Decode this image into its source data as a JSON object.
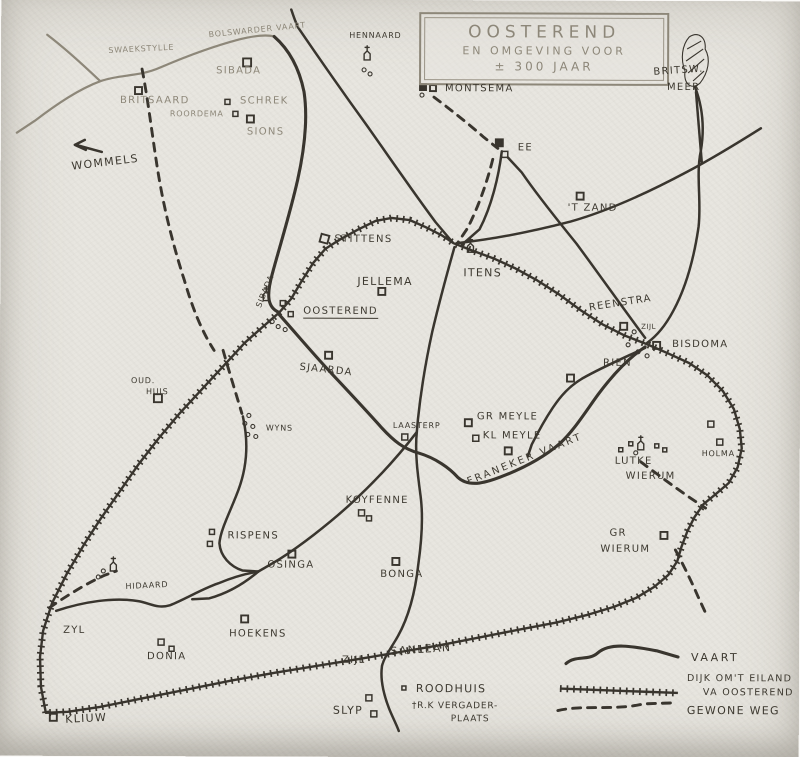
{
  "title": {
    "line1": "OOSTEREND",
    "line2": "EN OMGEVING VOOR",
    "line3": "± 300 JAAR"
  },
  "labels": {
    "swaekstylle": "SWAEKSTYLLE",
    "bolswarder_vaart": "BOLSWARDER VAART",
    "sibada_village": "SIBADA",
    "britsaard": "BRITSAARD",
    "schrek": "SCHREK",
    "roordema": "ROORDEMA",
    "sions": "SIONS",
    "wommels": "WOMMELS",
    "hennaard": "HENNAARD",
    "montsema": "MONTSEMA",
    "ee": "EE",
    "britsw": "BRITSW.",
    "meer": "MEER",
    "zand": "'T ZAND",
    "stittens": "STITTENS",
    "jellema": "JELLEMA",
    "itens": "ITENS",
    "oosterend": "OOSTEREND",
    "sibada_road": "SIBADA",
    "sjaarda": "SJAARDA",
    "reenstra": "REENSTRA",
    "zijl_reenstra": "ZIJL",
    "bisdoma": "BISDOMA",
    "rien": "RIEN",
    "oud": "OUD.",
    "huis": "HUIS",
    "wyns": "WYNS",
    "laasterp": "LAASTERP",
    "gr_meyle": "GR MEYLE",
    "kl_meyle": "KL MEYLE",
    "franeker_vaart": "FRANEKER VAART",
    "lutke": "LUTKE",
    "wierum_lutke": "WIERUM",
    "holma": "HOLMA",
    "gr": "GR",
    "wierum_gr": "WIERUM",
    "koyfenne": "KOYFENNE",
    "rispens": "RISPENS",
    "osinga": "OSINGA",
    "bonga": "BONGA",
    "hidaard": "HIDAARD",
    "zyl_west": "ZYL",
    "donia": "DONIA",
    "hoekens": "HOEKENS",
    "zijl_sanlean": "ZIJL",
    "sanlean": "SANLEAN",
    "roodhuis": "ROODHUIS",
    "rk_line1": "†R.K VERGADER-",
    "rk_line2": "PLAATS",
    "slyp": "SLYP",
    "kliuw": "KLIUW"
  },
  "legend": {
    "vaart": "VAART",
    "dijk_line1": "DIJK OM'T EILAND",
    "dijk_line2": "VA OOSTEREND",
    "weg": "GEWONE WEG"
  },
  "symbols": {
    "vaart_line": "solid-wavy-canal-line",
    "dijk_line": "hatched-dike-line",
    "weg_line": "dashed-road-line",
    "building": "open-square-marker",
    "church": "church-tower-marker",
    "lake": "hatched-lake-blob"
  },
  "colors": {
    "ink": "#39352e",
    "faint_ink": "#8d8779",
    "paper": "#e8e6e0"
  }
}
